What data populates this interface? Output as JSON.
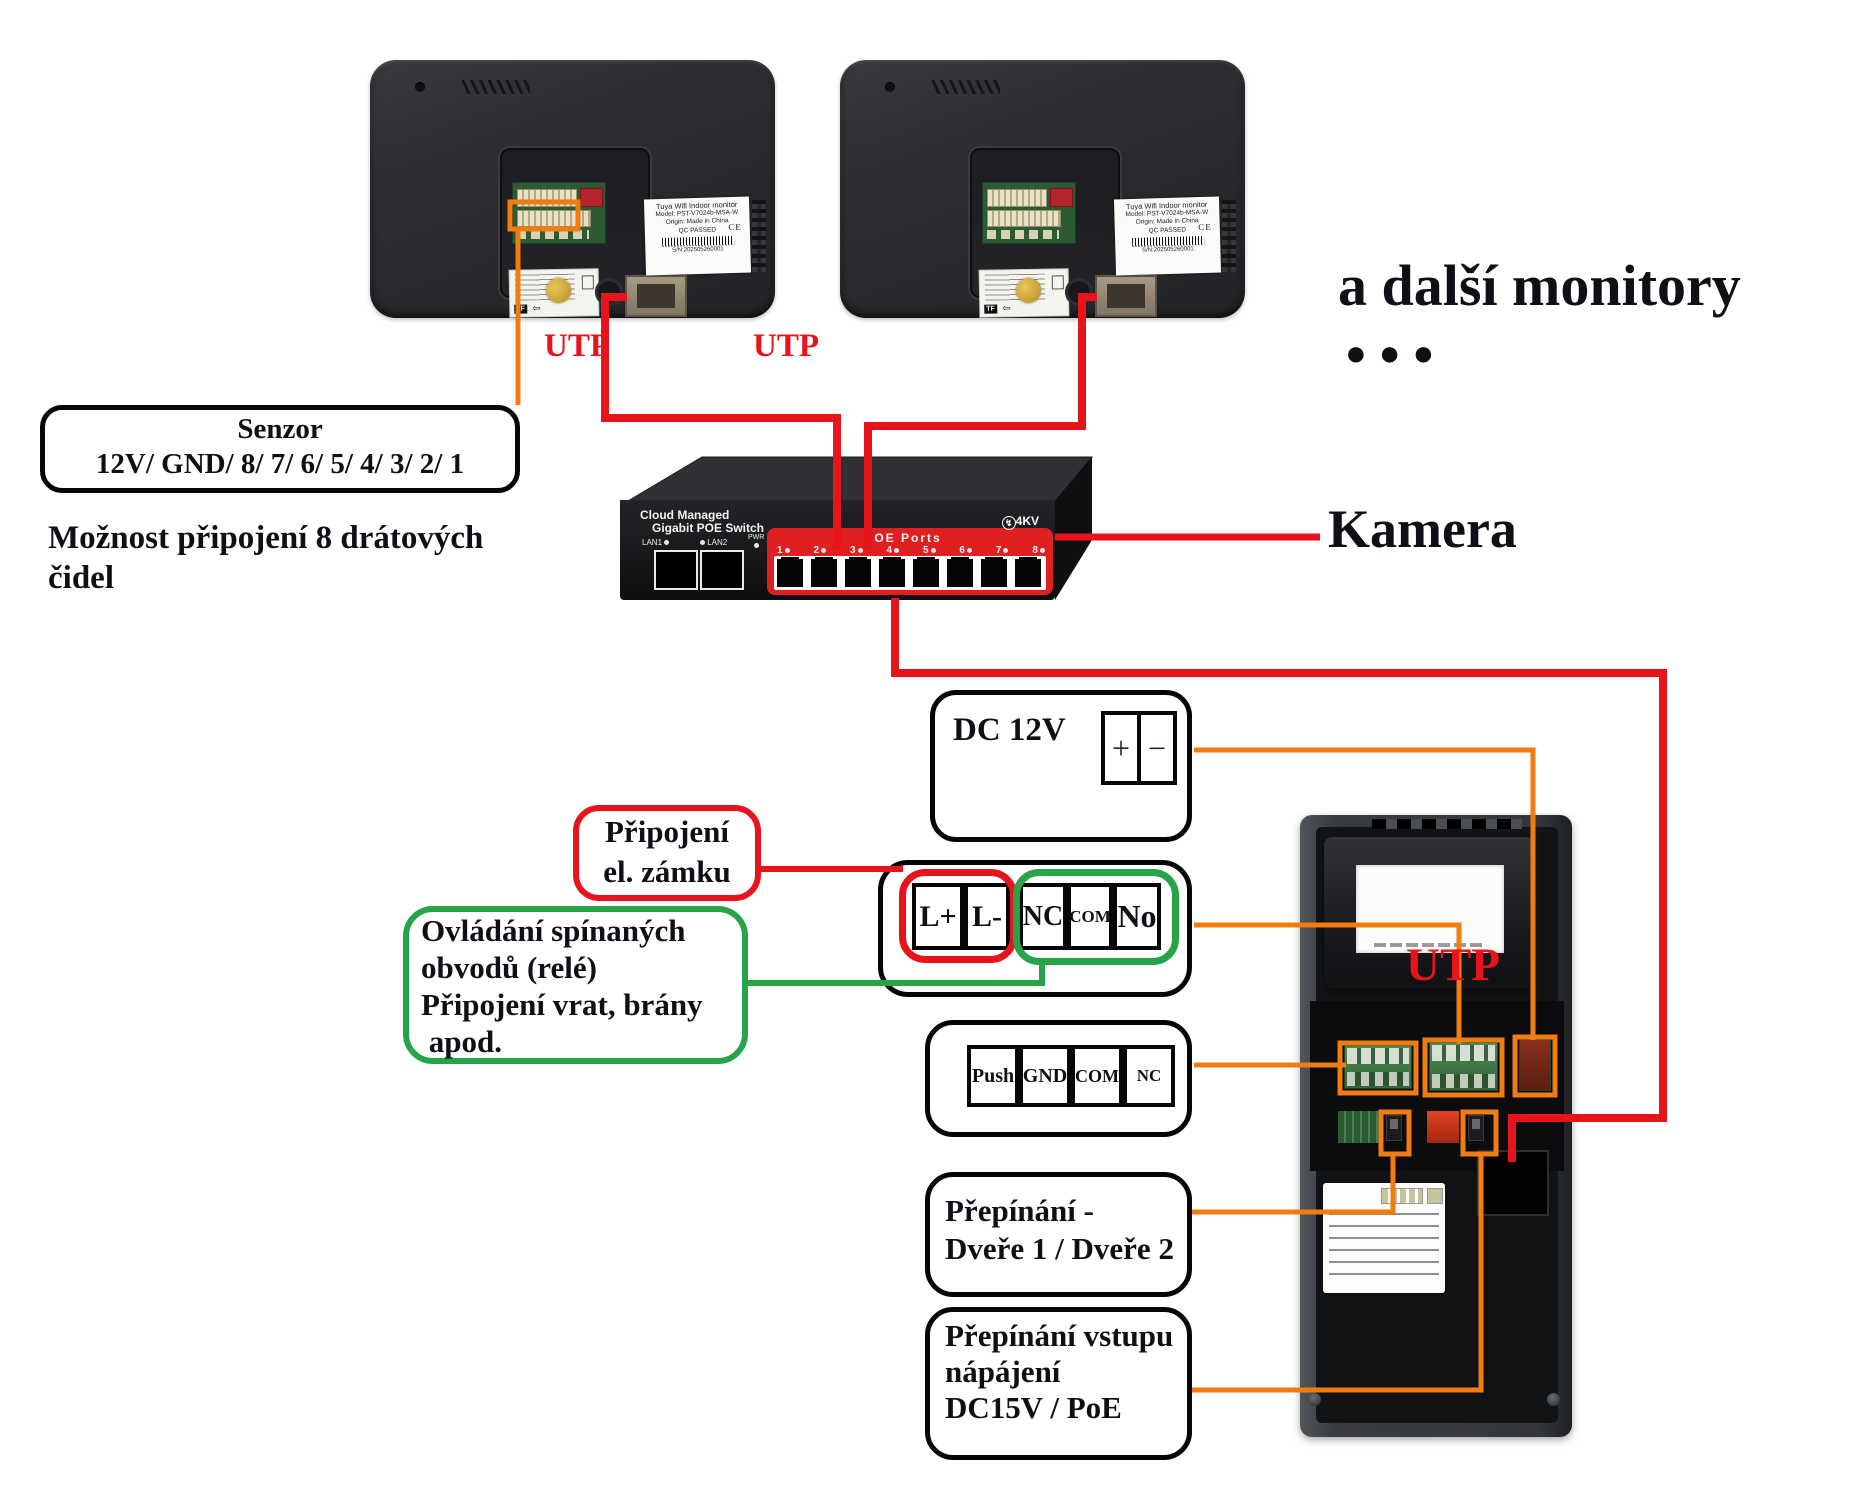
{
  "colors": {
    "wire_red": "#e8141c",
    "wire_orange": "#f07c12",
    "wire_green": "#27a348",
    "poe_panel_red": "#e02020"
  },
  "monitors": {
    "label": {
      "line1": "Tuya Wifi Indoor monitor",
      "line2": "Model: PST-V7024b-MSA-W",
      "line3": "Origin: Made in China",
      "line4": "QC PASSED",
      "ce": "CE",
      "serial": "S/N:202505260001"
    },
    "sticker_tf": "TF",
    "sticker_arrow": "⇦",
    "more_text": "a další monitory",
    "dots": "●●●"
  },
  "cables": {
    "utp1": "UTP",
    "utp2": "UTP",
    "utp_main": "UTP"
  },
  "switch": {
    "brand1": "Cloud Managed",
    "brand2": "Gigabit POE Switch",
    "lan1": "LAN1",
    "lan2": "LAN2",
    "pwr": "PWR",
    "poe_title": "POE  Ports",
    "surge_icon": "↯",
    "surge": "4KV",
    "led": "●",
    "ports": [
      "1",
      "2",
      "3",
      "4",
      "5",
      "6",
      "7",
      "8"
    ]
  },
  "camera_label": "Kamera",
  "callouts": {
    "senzor": {
      "title": "Senzor",
      "pins": "12V/ GND/ 8/ 7/ 6/ 5/ 4/ 3/ 2/ 1"
    },
    "senzor_note": {
      "line1": "Možnost připojení 8 drátových",
      "line2": "čidel"
    },
    "dc12v": {
      "label": "DC 12V",
      "plus": "+",
      "minus": "−"
    },
    "lock": {
      "line1": "Připojení",
      "line2": "el. zámku"
    },
    "relay": {
      "line1": "Ovládání spínaných",
      "line2": "obvodů (relé)",
      "line3": "Připojení vrat, brány",
      "line4": " apod."
    },
    "door_switch": {
      "line1": "Přepínání -",
      "line2": "Dveře 1 / Dveře 2"
    },
    "power_switch": {
      "line1": "Přepínání vstupu",
      "line2": "nápájení",
      "line3": "DC15V / PoE"
    }
  },
  "terminals": {
    "lock_relay": [
      {
        "label": "L+"
      },
      {
        "label": "L-"
      },
      {
        "label": "NC"
      },
      {
        "label": "COM"
      },
      {
        "label": "No"
      }
    ],
    "push_row": [
      {
        "label": "Push"
      },
      {
        "label": "GND"
      },
      {
        "label": "COM"
      },
      {
        "label": "NC"
      }
    ]
  }
}
